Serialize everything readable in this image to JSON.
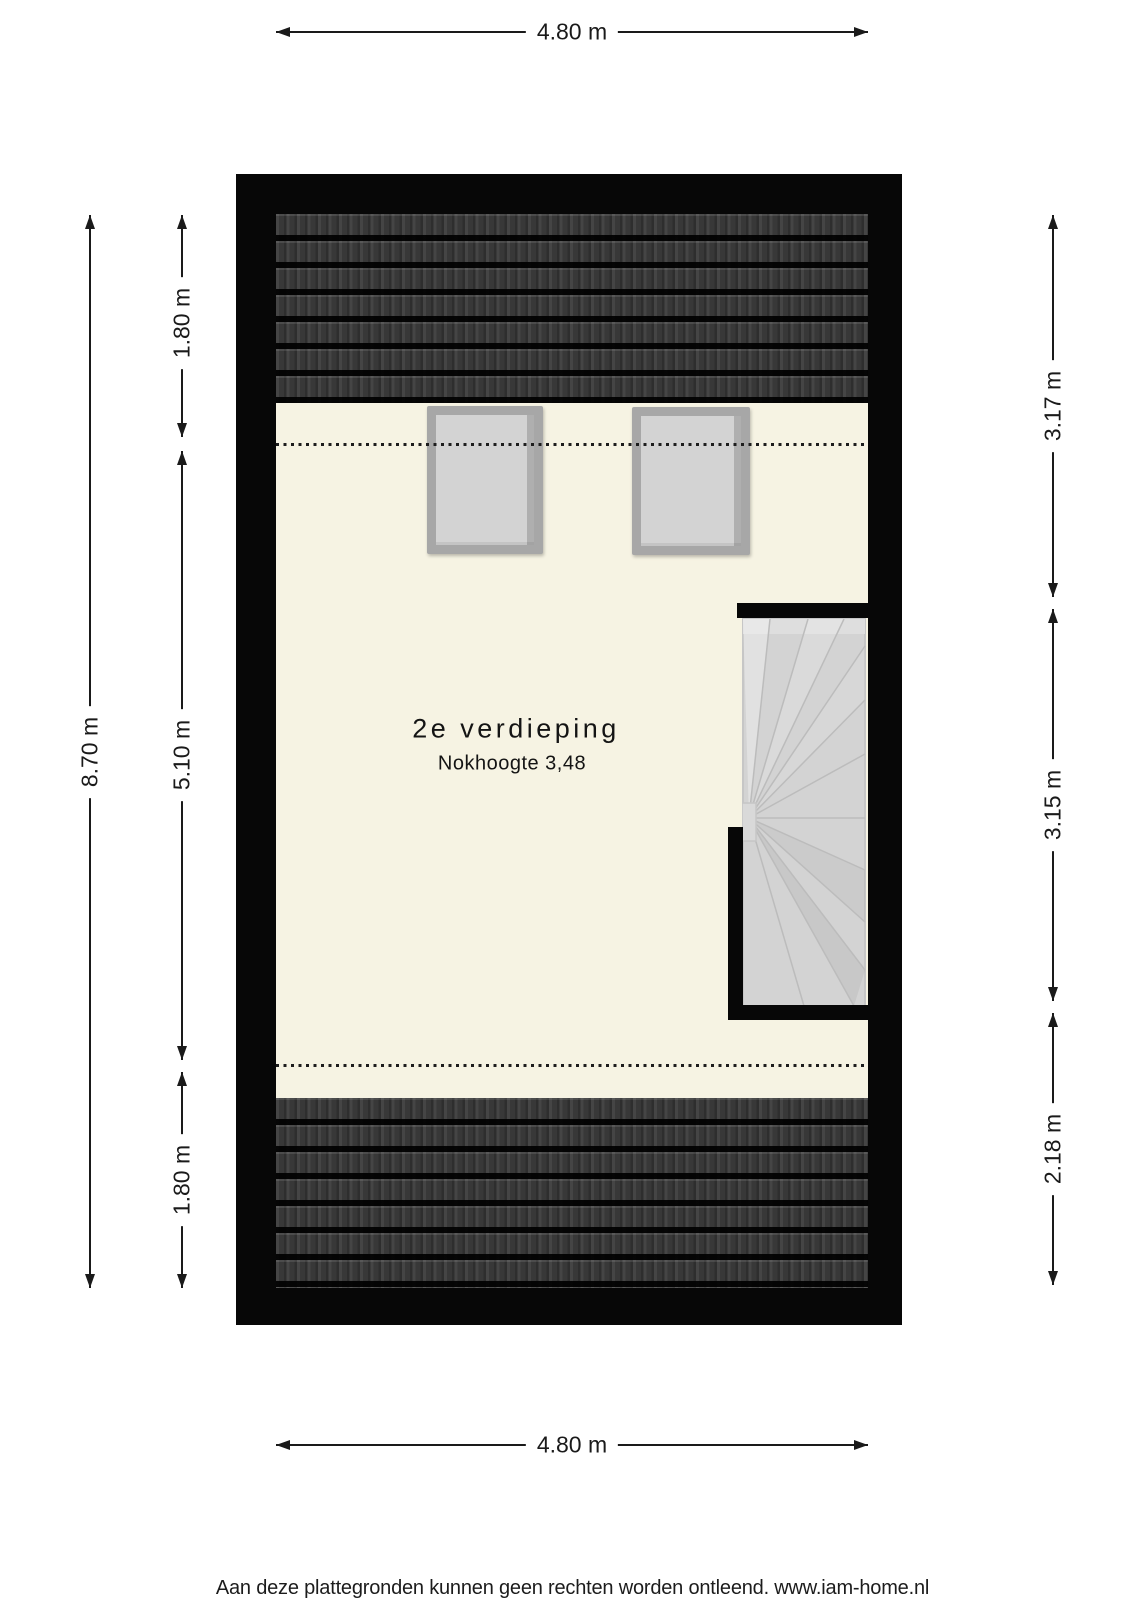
{
  "floorplan": {
    "title": "2e verdieping",
    "subtitle": "Nokhoogte 3,48",
    "dimensions": {
      "width_top": "4.80 m",
      "width_bottom": "4.80 m",
      "height_total": "8.70 m",
      "left_segments": [
        "1.80 m",
        "5.10 m",
        "1.80 m"
      ],
      "right_segments": [
        "3.17 m",
        "3.15 m",
        "2.18 m"
      ]
    },
    "features": {
      "skylight_count": 2,
      "staircase": "winder staircase, right side"
    },
    "colors": {
      "floor": "#f6f3e3",
      "wall": "#070707",
      "roof_tiles": "#3a3a3a",
      "stair": "#d3d3d3",
      "skylight_frame": "#a7a7a7",
      "skylight_pane": "#d3d3d3",
      "dimension_ink": "#1a1a1a"
    }
  },
  "page": {
    "footer": "Aan deze plattegronden kunnen geen rechten worden ontleend. www.iam-home.nl"
  }
}
